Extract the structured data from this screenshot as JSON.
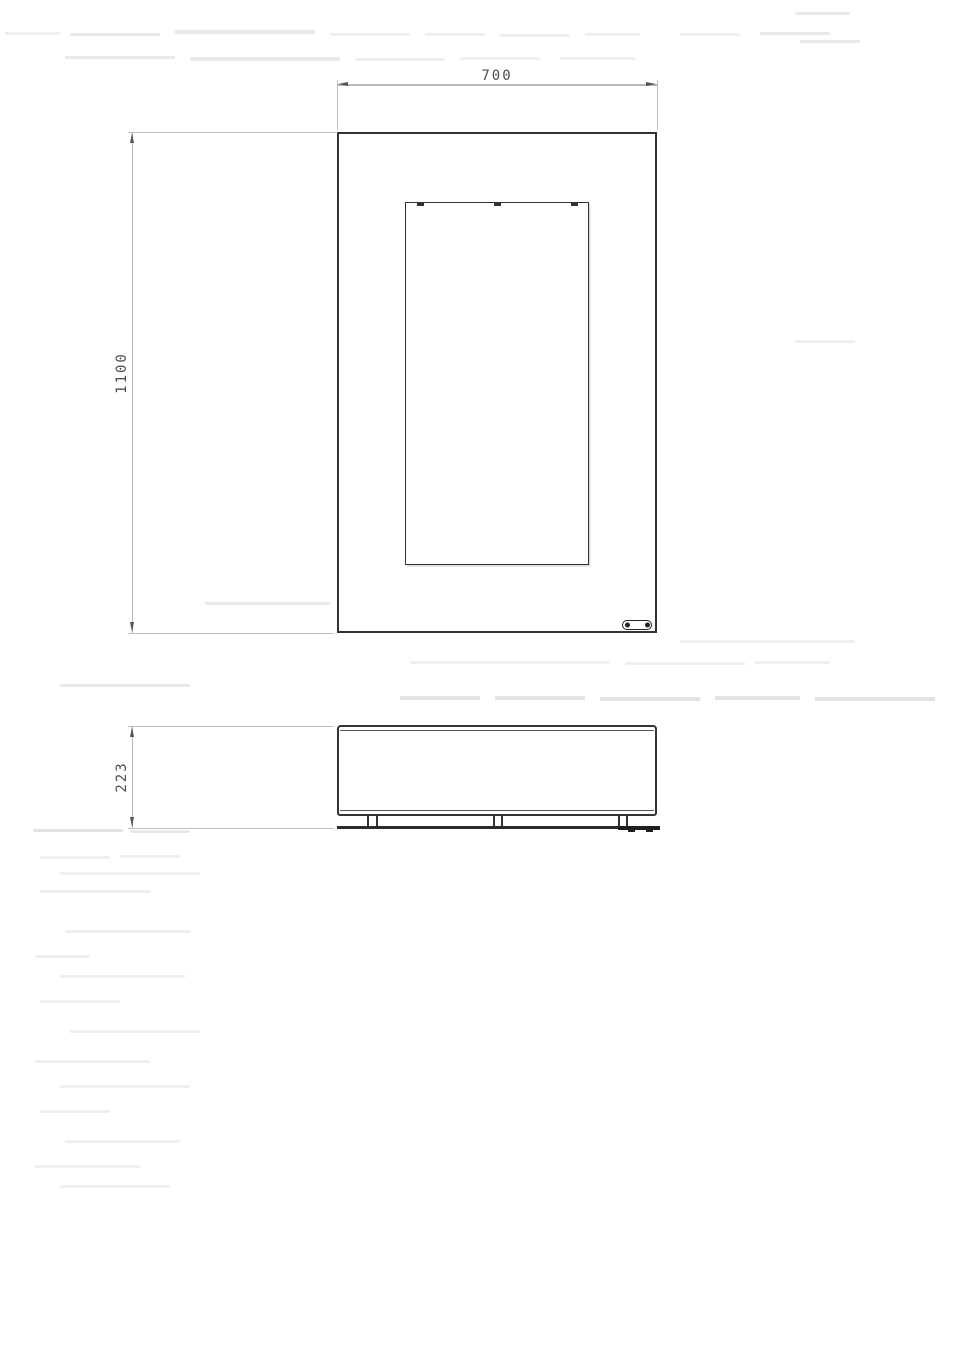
{
  "drawing": {
    "title": "",
    "views": {
      "front": {
        "name": "front view",
        "features": [
          "outer frame",
          "inner opening",
          "three top clips on opening",
          "oval nameplate bottom-right"
        ]
      },
      "plan": {
        "name": "depth view",
        "features": [
          "rounded body",
          "three pairs of mounting legs",
          "bottom rail with end cap and two feet"
        ]
      }
    },
    "dimensions": {
      "front_width": "700",
      "front_height": "1100",
      "side_depth": "223"
    },
    "colors": {
      "background": "#ffffff",
      "outline": "#333333",
      "dimension_line": "#b8b8b8",
      "extension_line": "#c0c0c0",
      "arrow": "#555555",
      "dimension_text": "#4d4d4d"
    }
  }
}
